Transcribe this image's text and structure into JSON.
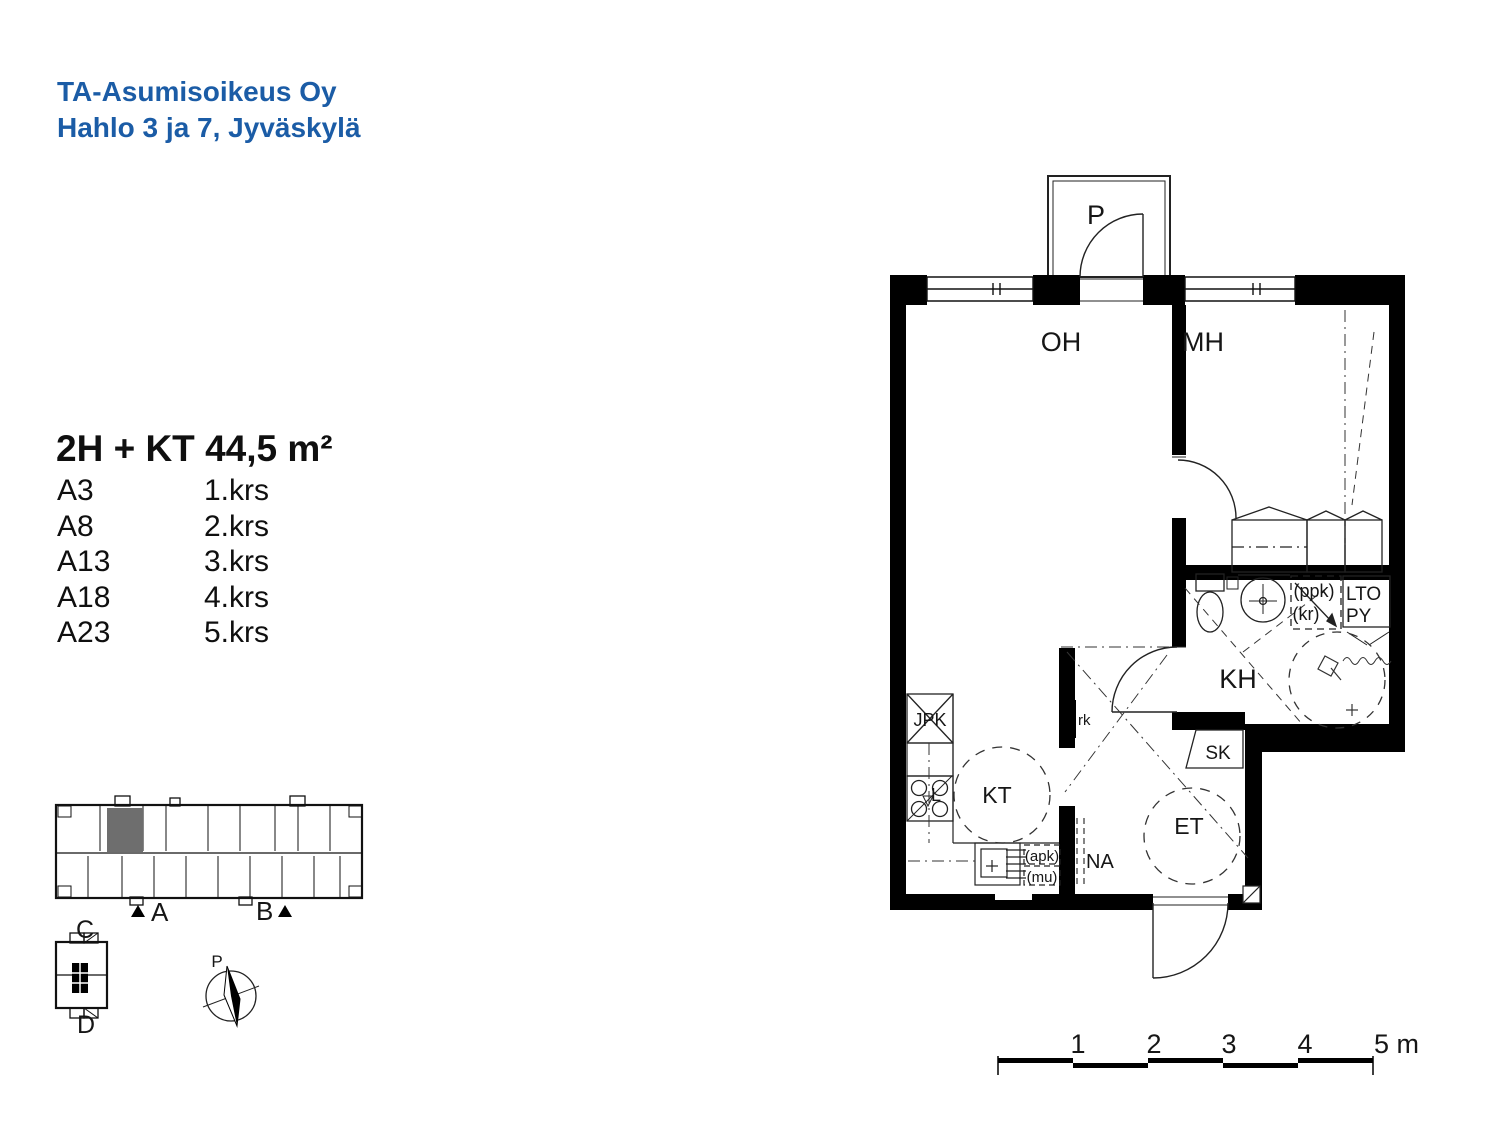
{
  "header": {
    "line1": "TA-Asumisoikeus Oy",
    "line2": "Hahlo 3 ja 7, Jyväskylä"
  },
  "apartment": {
    "title": "2H + KT 44,5 m²",
    "units": [
      {
        "code": "A3",
        "floor": "1.krs"
      },
      {
        "code": "A8",
        "floor": "2.krs"
      },
      {
        "code": "A13",
        "floor": "3.krs"
      },
      {
        "code": "A18",
        "floor": "4.krs"
      },
      {
        "code": "A23",
        "floor": "5.krs"
      }
    ]
  },
  "floorplan": {
    "balcony": "P",
    "living": "OH",
    "bedroom": "MH",
    "bathroom": "KH",
    "kitchen": "KT",
    "entry": "ET",
    "cleaning_closet": "SK",
    "coat_rack": "NA",
    "fridge_freezer": "JPK",
    "stove": "L",
    "electrical_cabinet": "rk",
    "dishwasher_reservation": "(apk)",
    "microwave_reservation": "(mu)",
    "washer_reservation": "(ppk)",
    "dryer_reservation": "(kr)",
    "heat_recovery": "LTO",
    "laundry": "PY"
  },
  "siteplan": {
    "stairwell_a": "A",
    "stairwell_b": "B",
    "stairwell_c": "C",
    "stairwell_d": "D",
    "north": "P",
    "highlight_color": "#6e6e6e"
  },
  "scalebar": {
    "ticks": [
      "1",
      "2",
      "3",
      "4"
    ],
    "end_label": "5 m"
  },
  "colors": {
    "accent": "#1b5ca6",
    "ink": "#000000"
  }
}
